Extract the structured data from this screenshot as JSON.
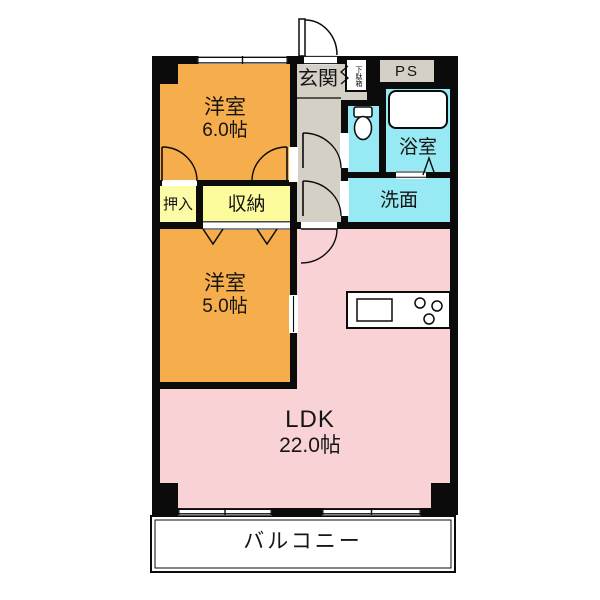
{
  "colors": {
    "wall": "#0b0b0b",
    "western_room": "#F5AE4B",
    "closet_oshiire": "#FCFCA8",
    "closet_shuunou": "#FBFB9B",
    "wet_area": "#97E9F4",
    "ldk": "#F9D2D6",
    "entrance_hall": "#D4D0C6"
  },
  "rooms": {
    "western_room_6": {
      "name": "洋室",
      "size": "6.0帖"
    },
    "western_room_5": {
      "name": "洋室",
      "size": "5.0帖"
    },
    "ldk": {
      "name": "LDK",
      "size": "22.0帖"
    },
    "entrance": {
      "name": "玄関"
    },
    "shoe_cabinet": {
      "name": "下駄箱"
    },
    "pipe_space": {
      "name": "PS"
    },
    "bathroom": {
      "name": "浴室"
    },
    "washroom": {
      "name": "洗面"
    },
    "closet_oshiire": {
      "name": "押入"
    },
    "closet_shuunou": {
      "name": "収納"
    },
    "balcony": {
      "name": "バルコニー"
    }
  }
}
